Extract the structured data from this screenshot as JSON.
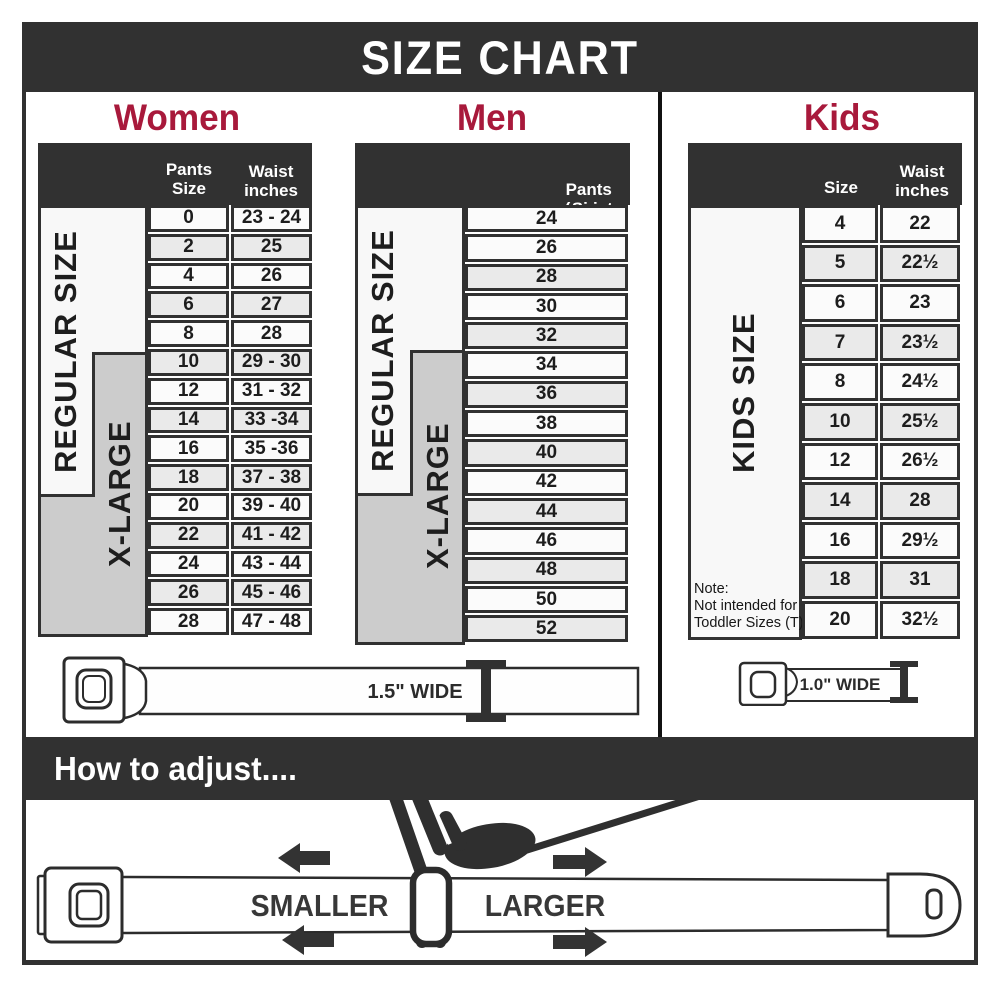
{
  "title": "SIZE CHART",
  "colors": {
    "dark": "#313131",
    "accent": "#A8193B",
    "row": "#fbfbfb",
    "row_alt": "#eaeaea",
    "xlarge_gray": "#cccccc"
  },
  "women": {
    "heading": "Women",
    "header": {
      "pants": "Pants Size",
      "waist": "Waist inches"
    },
    "regular_label": "REGULAR SIZE",
    "xlarge_label": "X-LARGE",
    "rows": [
      {
        "size": "0",
        "waist": "23 - 24"
      },
      {
        "size": "2",
        "waist": "25"
      },
      {
        "size": "4",
        "waist": "26"
      },
      {
        "size": "6",
        "waist": "27"
      },
      {
        "size": "8",
        "waist": "28"
      },
      {
        "size": "10",
        "waist": "29 - 30"
      },
      {
        "size": "12",
        "waist": "31 - 32"
      },
      {
        "size": "14",
        "waist": "33 -34"
      },
      {
        "size": "16",
        "waist": "35 -36"
      },
      {
        "size": "18",
        "waist": "37 - 38"
      },
      {
        "size": "20",
        "waist": "39 - 40"
      },
      {
        "size": "22",
        "waist": "41 - 42"
      },
      {
        "size": "24",
        "waist": "43 - 44"
      },
      {
        "size": "26",
        "waist": "45 - 46"
      },
      {
        "size": "28",
        "waist": "47 - 48"
      }
    ]
  },
  "men": {
    "heading": "Men",
    "header_line1": "Pants Size",
    "header_line2": "(waist inches)",
    "regular_label": "REGULAR SIZE",
    "xlarge_label": "X-LARGE",
    "rows": [
      "24",
      "26",
      "28",
      "30",
      "32",
      "34",
      "36",
      "38",
      "40",
      "42",
      "44",
      "46",
      "48",
      "50",
      "52"
    ]
  },
  "kids": {
    "heading": "Kids",
    "header": {
      "size": "Size",
      "waist": "Waist inches"
    },
    "label": "KIDS SIZE",
    "note_line1": "Note:",
    "note_line2": "Not intended for",
    "note_line3": "Toddler Sizes (T)",
    "rows": [
      {
        "size": "4",
        "waist": "22"
      },
      {
        "size": "5",
        "waist": "22½"
      },
      {
        "size": "6",
        "waist": "23"
      },
      {
        "size": "7",
        "waist": "23½"
      },
      {
        "size": "8",
        "waist": "24½"
      },
      {
        "size": "10",
        "waist": "25½"
      },
      {
        "size": "12",
        "waist": "26½"
      },
      {
        "size": "14",
        "waist": "28"
      },
      {
        "size": "16",
        "waist": "29½"
      },
      {
        "size": "18",
        "waist": "31"
      },
      {
        "size": "20",
        "waist": "32½"
      }
    ]
  },
  "belts": {
    "adult_width_label": "1.5\" WIDE",
    "kids_width_label": "1.0\" WIDE"
  },
  "adjust": {
    "heading": "How to adjust....",
    "smaller": "SMALLER",
    "larger": "LARGER"
  }
}
